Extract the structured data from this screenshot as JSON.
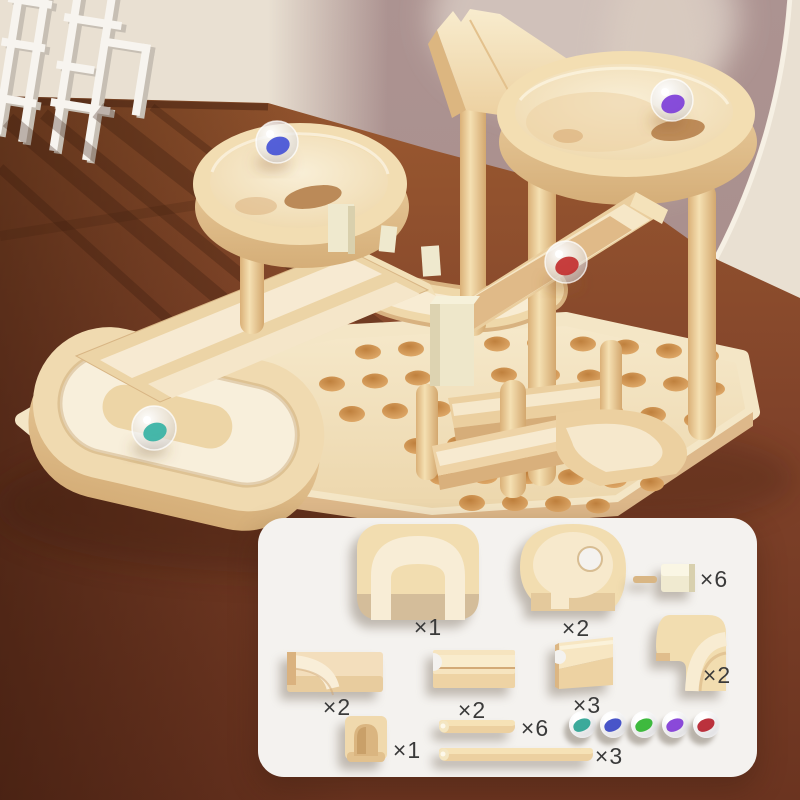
{
  "parts_panel": {
    "items": [
      {
        "name": "arch-end-tray",
        "qty": "×1"
      },
      {
        "name": "round-tray",
        "qty": "×2"
      },
      {
        "name": "clip-connector",
        "qty": "×6"
      },
      {
        "name": "curve-chute",
        "qty": "×2"
      },
      {
        "name": "straight-channel",
        "qty": "×2"
      },
      {
        "name": "slope-ramp",
        "qty": "×3"
      },
      {
        "name": "corner-channel",
        "qty": "×2"
      },
      {
        "name": "arch-block",
        "qty": "×1"
      },
      {
        "name": "short-dowel",
        "qty": "×6"
      },
      {
        "name": "long-dowel",
        "qty": "×3"
      }
    ],
    "marble_colors": [
      "#2ba393",
      "#3847c4",
      "#2eb42e",
      "#8039d6",
      "#b5202c"
    ]
  },
  "scene": {
    "marbles": [
      {
        "location": "top-round-tray",
        "color": "#7d3ed8"
      },
      {
        "location": "left-round-tray",
        "color": "#4553d6"
      },
      {
        "location": "slope-chute",
        "color": "#c22f2f"
      },
      {
        "location": "u-turn-tray",
        "color": "#36b2a4"
      }
    ]
  },
  "colors": {
    "wall_left": "#e9e0d2",
    "wall_right": "#b29795",
    "arch_rim": "#f7f0e5",
    "floor": "#8a4a2c",
    "wood": "#f0d9ad",
    "wood_side": "#ddb584",
    "board_hole": "#d2954f",
    "cream_clip": "#efe9ce",
    "panel": "#f4f2ef",
    "label": "#3a3a3a"
  }
}
